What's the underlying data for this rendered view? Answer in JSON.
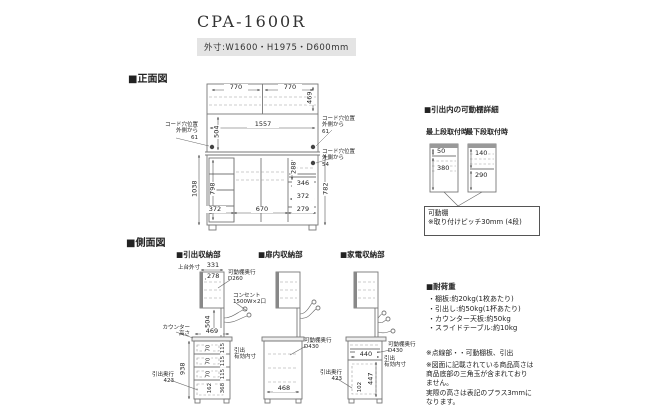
{
  "title": "CPA-1600R",
  "spec": "外寸:W1600・H1975・D600mm",
  "front": {
    "heading": "■正面図",
    "dims": {
      "w_left": "770",
      "w_right": "770",
      "h_upper": "469",
      "w_inner": "1557",
      "h_mid": "504",
      "h_left_total": "1038",
      "h_door": "798",
      "h_slot": "288",
      "w_346": "346",
      "w_372": "372",
      "h_right": "782",
      "b_left": "372",
      "b_mid": "670",
      "b_right": "279"
    },
    "cord_left": "コード穴位置\n外側から\n61",
    "cord_right_top": "コード穴位置\n外側から\n61",
    "cord_right_bottom": "コード穴位置\n外側から\n54"
  },
  "shelf_detail": {
    "heading": "■引出内の可動棚詳細",
    "top_label": "最上段取付時",
    "bottom_label": "最下段取付時",
    "top_dims": {
      "a": "50",
      "b": "380"
    },
    "bottom_dims": {
      "a": "140",
      "b": "290"
    },
    "callout": "可動棚\n※取り付けピッチ30mm (4段)"
  },
  "side": {
    "heading": "■側面図",
    "drawer": {
      "heading": "■引出収納部",
      "top_label": "上台外寸",
      "d331": "331",
      "d278": "278",
      "shelf_depth": "可動棚奥行\nD260",
      "outlet": "コンセント\n1500W×2口",
      "d504": "504",
      "counter_label": "カウンター\n高さ",
      "d469": "469",
      "d938": "938",
      "inner": [
        "70",
        "70",
        "70",
        "162"
      ],
      "pitch": [
        "115",
        "115",
        "115",
        "368"
      ],
      "effective": "引出\n有効内寸",
      "depth": "引出奥行\n423"
    },
    "door": {
      "heading": "■扉内収納部",
      "shelf_depth": "可動棚奥行\nD430",
      "d468": "468"
    },
    "appliance": {
      "heading": "■家電収納部",
      "d440": "440",
      "shelf_depth": "可動棚奥行\nD430",
      "effective": "引出\n有効内寸",
      "d447": "447",
      "d102": "102",
      "depth": "引出奥行\n423"
    }
  },
  "load": {
    "heading": "■耐荷重",
    "items": [
      "・棚板:約20kg(1枚あたり)",
      "・引出し:約50kg(1杯あたり)",
      "・カウンター天板:約50kg",
      "・スライドテーブル:約10kg"
    ],
    "note1": "※点線部・・可動棚板、引出",
    "note2": "※図面に記載されている商品高さは\n商品底部の三角玉が含まれており\nません。\n実際の高さは表記のプラス3mmに\nなります。"
  }
}
